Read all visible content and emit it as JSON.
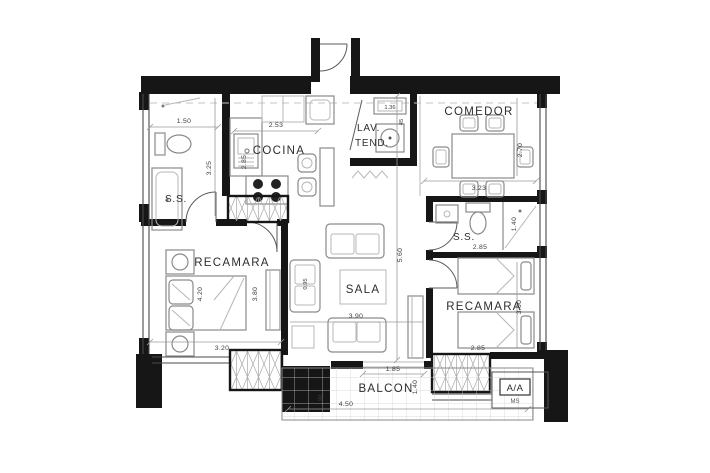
{
  "plan": {
    "rooms": {
      "ss_left": {
        "label": "S.S.",
        "dim_width": "1.50",
        "dim_height": "3.25"
      },
      "cocina": {
        "label": "COCINA",
        "dim_width": "2.53",
        "dim_height": "2.85"
      },
      "lav_tend": {
        "line1": "LAV.",
        "line2": "TEND.",
        "dim_width": "1.36",
        "dim_depth": "45"
      },
      "comedor": {
        "label": "COMEDOR",
        "dim_width": "3.23",
        "dim_height": "2.70"
      },
      "ss_right": {
        "label": "S.S.",
        "dim_width": "2.85",
        "dim_height": "1.40"
      },
      "recamara_left": {
        "label": "RECAMARA",
        "dim_bed": "4.20",
        "dim_height": "3.80",
        "dim_width": "3.20"
      },
      "sala": {
        "label": "SALA",
        "dim_height": "5.60",
        "dim_width": "3.90",
        "dim_sofa": "0.95"
      },
      "recamara_right": {
        "label": "RECAMARA",
        "dim_height": "3.00",
        "dim_width": "2.85"
      },
      "balcon": {
        "label": "BALCON",
        "dim_opening": "1.85",
        "dim_depth": "1.40",
        "dim_width": "4.50",
        "dim_rail": "90"
      },
      "ac": {
        "label": "A/A",
        "sublabel": "MS"
      }
    },
    "colors": {
      "wall": "#161616",
      "furniture_line": "#8a8a8a",
      "dim_text": "#3c3c3c"
    }
  }
}
